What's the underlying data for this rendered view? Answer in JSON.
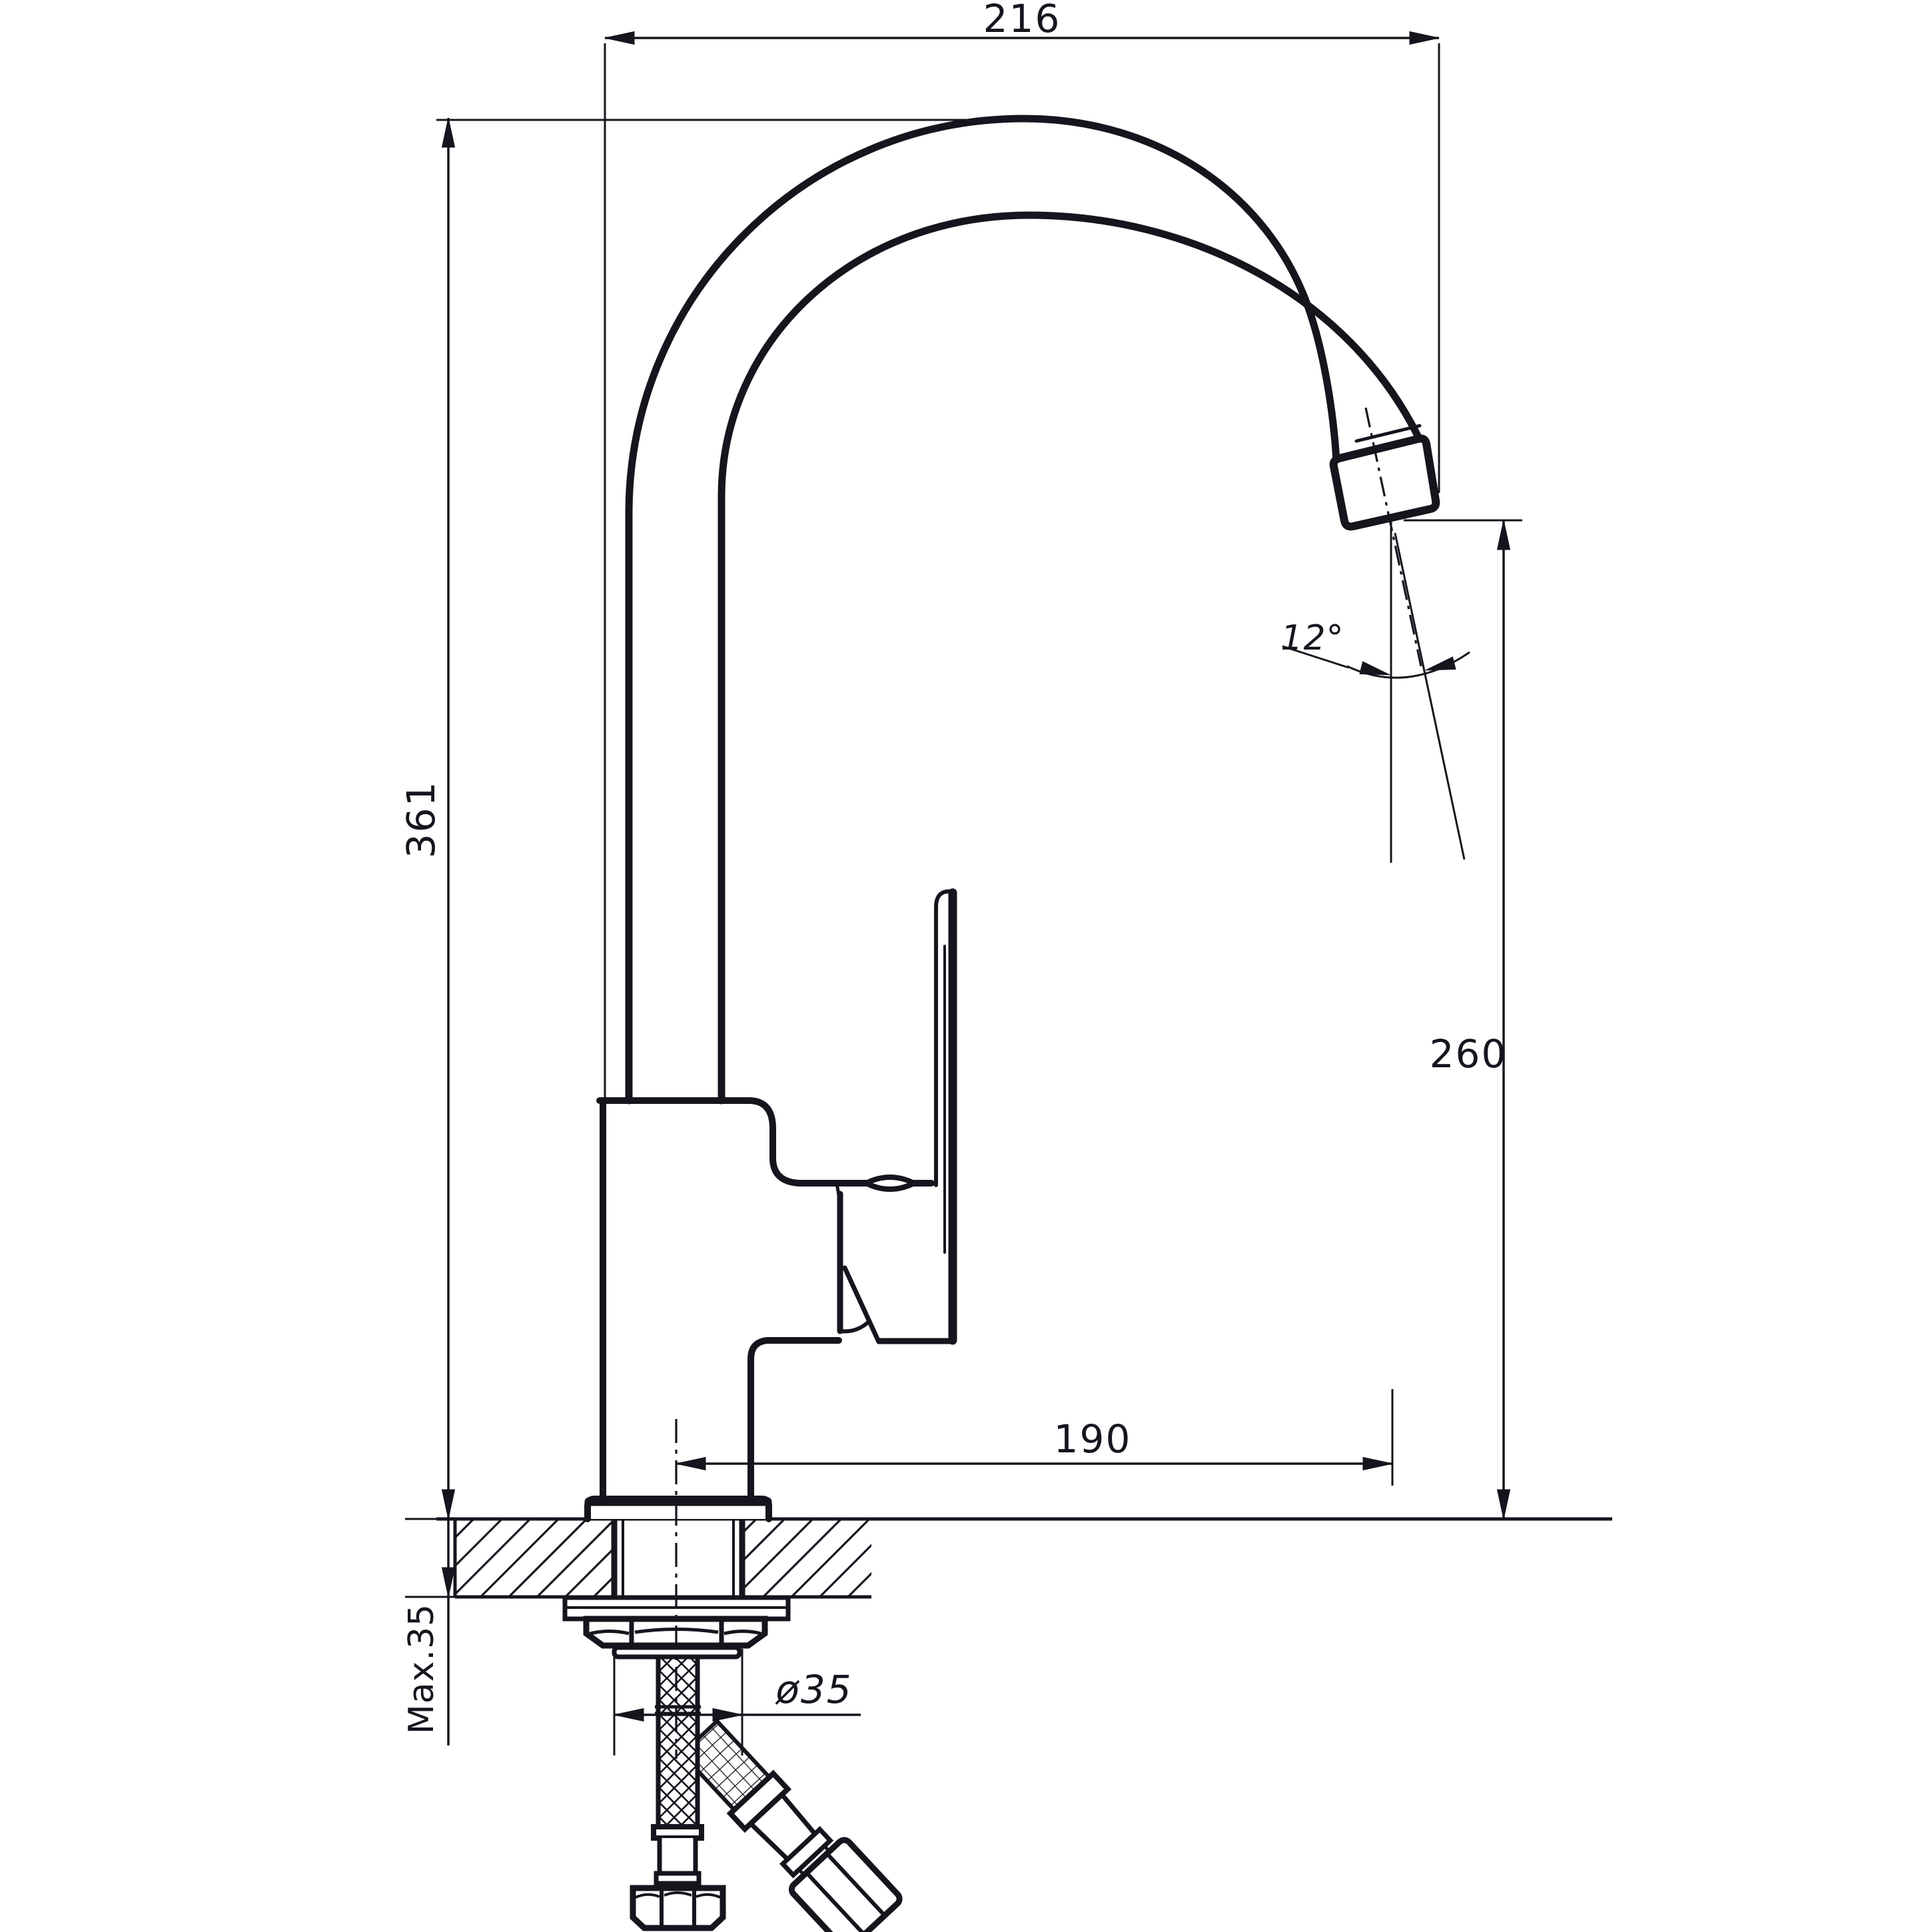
{
  "drawing": {
    "kind": "technical-dimension-drawing",
    "subject": "kitchen sink mixer faucet side elevation with mounting hoses",
    "background_color": "#ffffff",
    "ink_color": "#15151e",
    "dims": {
      "spout_reach_overall": "216",
      "total_height": "361",
      "outlet_height": "260",
      "outlet_reach": "190",
      "outlet_angle": "12°",
      "mount_hole_diameter": "ø35",
      "max_deck_thickness": "Max.35"
    },
    "parts": [
      "gooseneck spout",
      "aerator tip",
      "lever handle",
      "mixer body",
      "base flange",
      "countertop section",
      "mounting shank",
      "lock nut",
      "washer",
      "braided supply hose vertical",
      "braided supply hose diagonal"
    ]
  }
}
